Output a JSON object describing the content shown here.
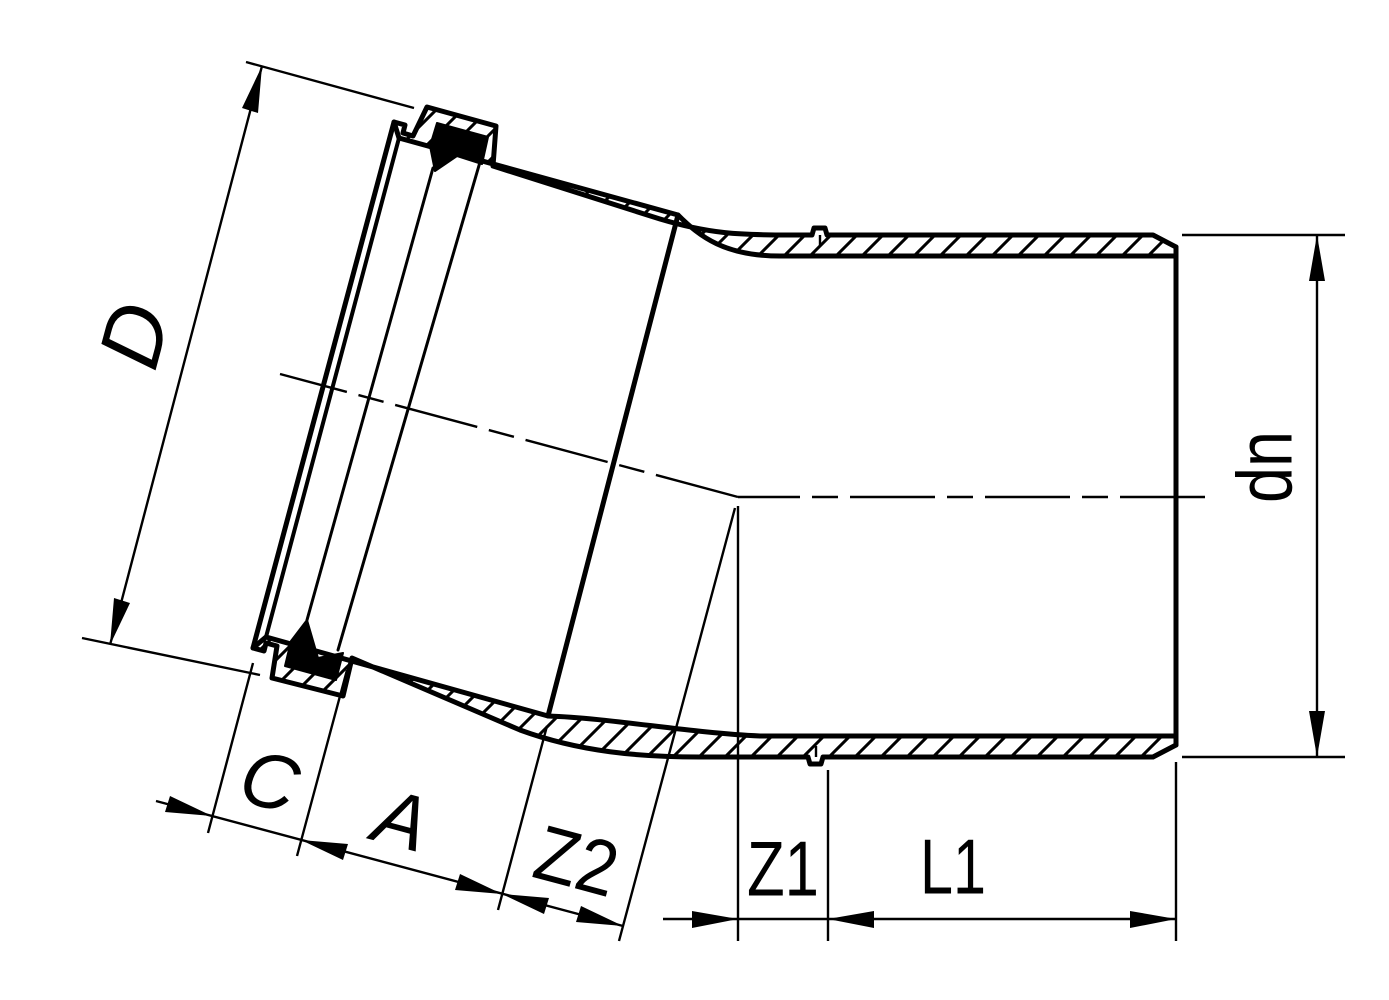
{
  "drawing": {
    "kind": "pipe-bend-fitting-section",
    "labels": {
      "d": "D",
      "c": "C",
      "a": "A",
      "z2": "Z2",
      "z1": "Z1",
      "l1": "L1",
      "dn": "dn"
    },
    "colors": {
      "line": "#000000",
      "background": "#ffffff",
      "seal": "#000000"
    }
  }
}
